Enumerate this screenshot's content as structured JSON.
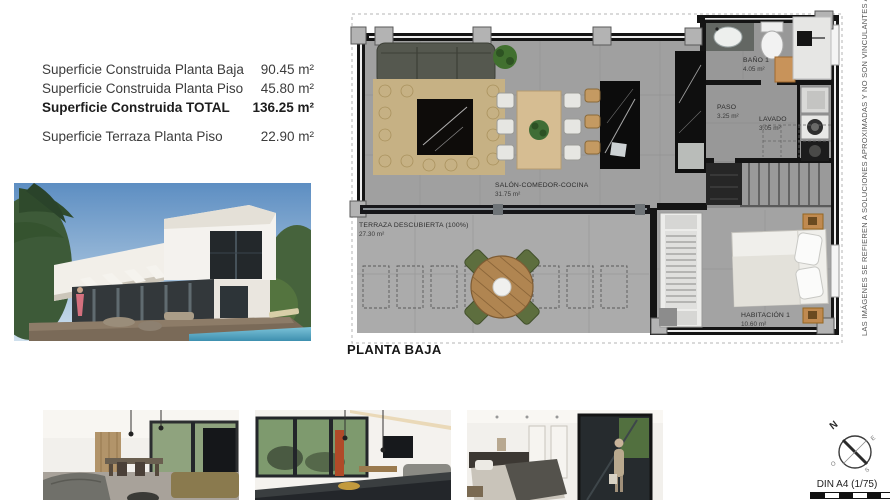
{
  "surface_table": {
    "rows": [
      {
        "label": "Superficie Construida Planta Baja",
        "value": "90.45 m²"
      },
      {
        "label": "Superficie Construida Planta Piso",
        "value": "45.80 m²"
      },
      {
        "label": "Superficie Construida TOTAL",
        "value": "136.25 m²"
      },
      {
        "label": "Superficie Terraza Planta Piso",
        "value": "22.90 m²"
      }
    ]
  },
  "floor_plan": {
    "title": "PLANTA BAJA",
    "rooms": {
      "salon": {
        "name": "SALÓN-COMEDOR-COCINA",
        "area": "31.75 m²"
      },
      "terraza": {
        "name": "TERRAZA DESCUBIERTA (100%)",
        "area": "27.30 m²"
      },
      "bano": {
        "name": "BAÑO 1",
        "area": "4.05 m²"
      },
      "paso": {
        "name": "PASO",
        "area": "3.25 m²"
      },
      "lavado": {
        "name": "LAVADO",
        "area": "3.05 m²"
      },
      "habitacion": {
        "name": "HABITACIÓN 1",
        "area": "10.60 m²"
      }
    }
  },
  "disclaimer": "LAS IMÁGENES SE REFIEREN A SOLUCIONES APROXIMADAS Y NO SON VINCULANTES AL PROYECTO FINAL",
  "footer": {
    "scale_label": "DIN A4 (1/75)",
    "compass": {
      "north": "N",
      "east": "E",
      "south": "S",
      "west": "O"
    }
  },
  "colors": {
    "wall": "#141414",
    "floor": "#a0a0a0",
    "terrace_floor": "#ababab",
    "rug": "#c6b184",
    "wood": "#d6bd92",
    "accent_tan": "#c8935a",
    "plant_green": "#41702f",
    "sky_blue": "#5d8ec2",
    "pool_blue": "#4a9ab8"
  }
}
